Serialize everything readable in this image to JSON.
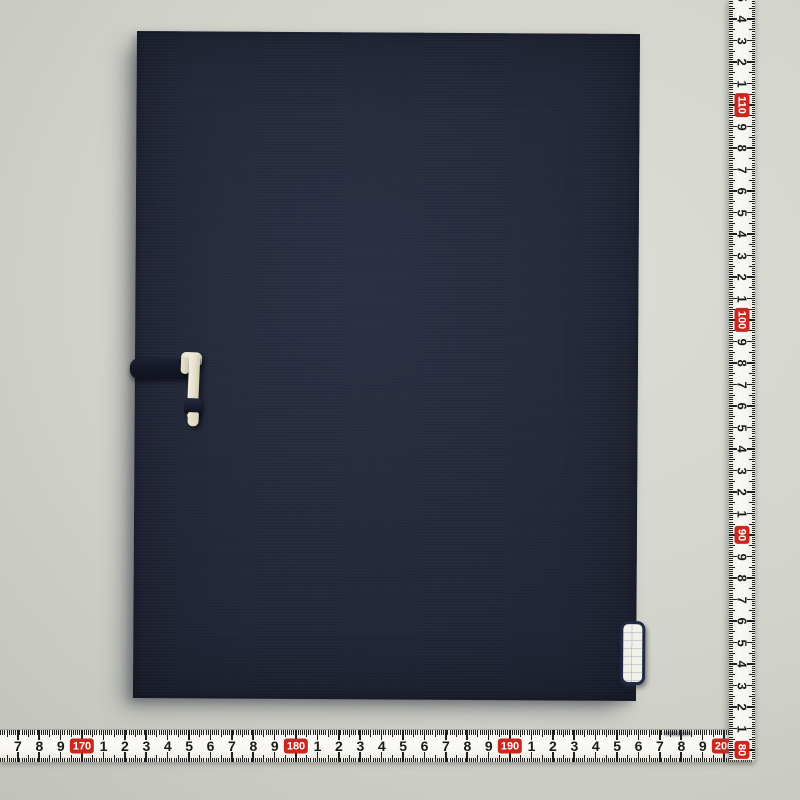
{
  "scene": {
    "kind": "product-photo",
    "background_color": "#d3d4cc",
    "portfolio": {
      "cover_color": "#232839",
      "clasp_strap_color": "#141828",
      "clasp_hook_color": "#e9e4d0",
      "edge_label_color": "#f1f1ea",
      "edge_label_border_color": "#222840"
    }
  },
  "rulers": {
    "tape_color": "#f6f5f0",
    "tick_color": "#1f1f1f",
    "red_box_color": "#c9281f",
    "red_box_text_color": "#ffffff",
    "vertical": {
      "red_labels": [
        "110",
        "100",
        "90",
        "80"
      ],
      "cm_labels": [
        "5",
        "4",
        "3",
        "2",
        "1",
        "110",
        "9",
        "8",
        "7",
        "6",
        "5",
        "4",
        "3",
        "2",
        "1",
        "100",
        "9",
        "8",
        "7",
        "6",
        "5",
        "4",
        "3",
        "2",
        "1",
        "90",
        "9",
        "8",
        "7",
        "6",
        "5",
        "4",
        "3",
        "2",
        "1",
        "80"
      ]
    },
    "horizontal": {
      "red_labels": [
        "170",
        "180",
        "190",
        "200"
      ],
      "cm_labels": [
        "7",
        "8",
        "9",
        "170",
        "1",
        "2",
        "3",
        "4",
        "5",
        "6",
        "7",
        "8",
        "9",
        "180",
        "1",
        "2",
        "3",
        "4",
        "5",
        "6",
        "7",
        "8",
        "9",
        "190",
        "1",
        "2",
        "3",
        "4",
        "5",
        "6",
        "7",
        "8",
        "9",
        "200"
      ]
    }
  }
}
